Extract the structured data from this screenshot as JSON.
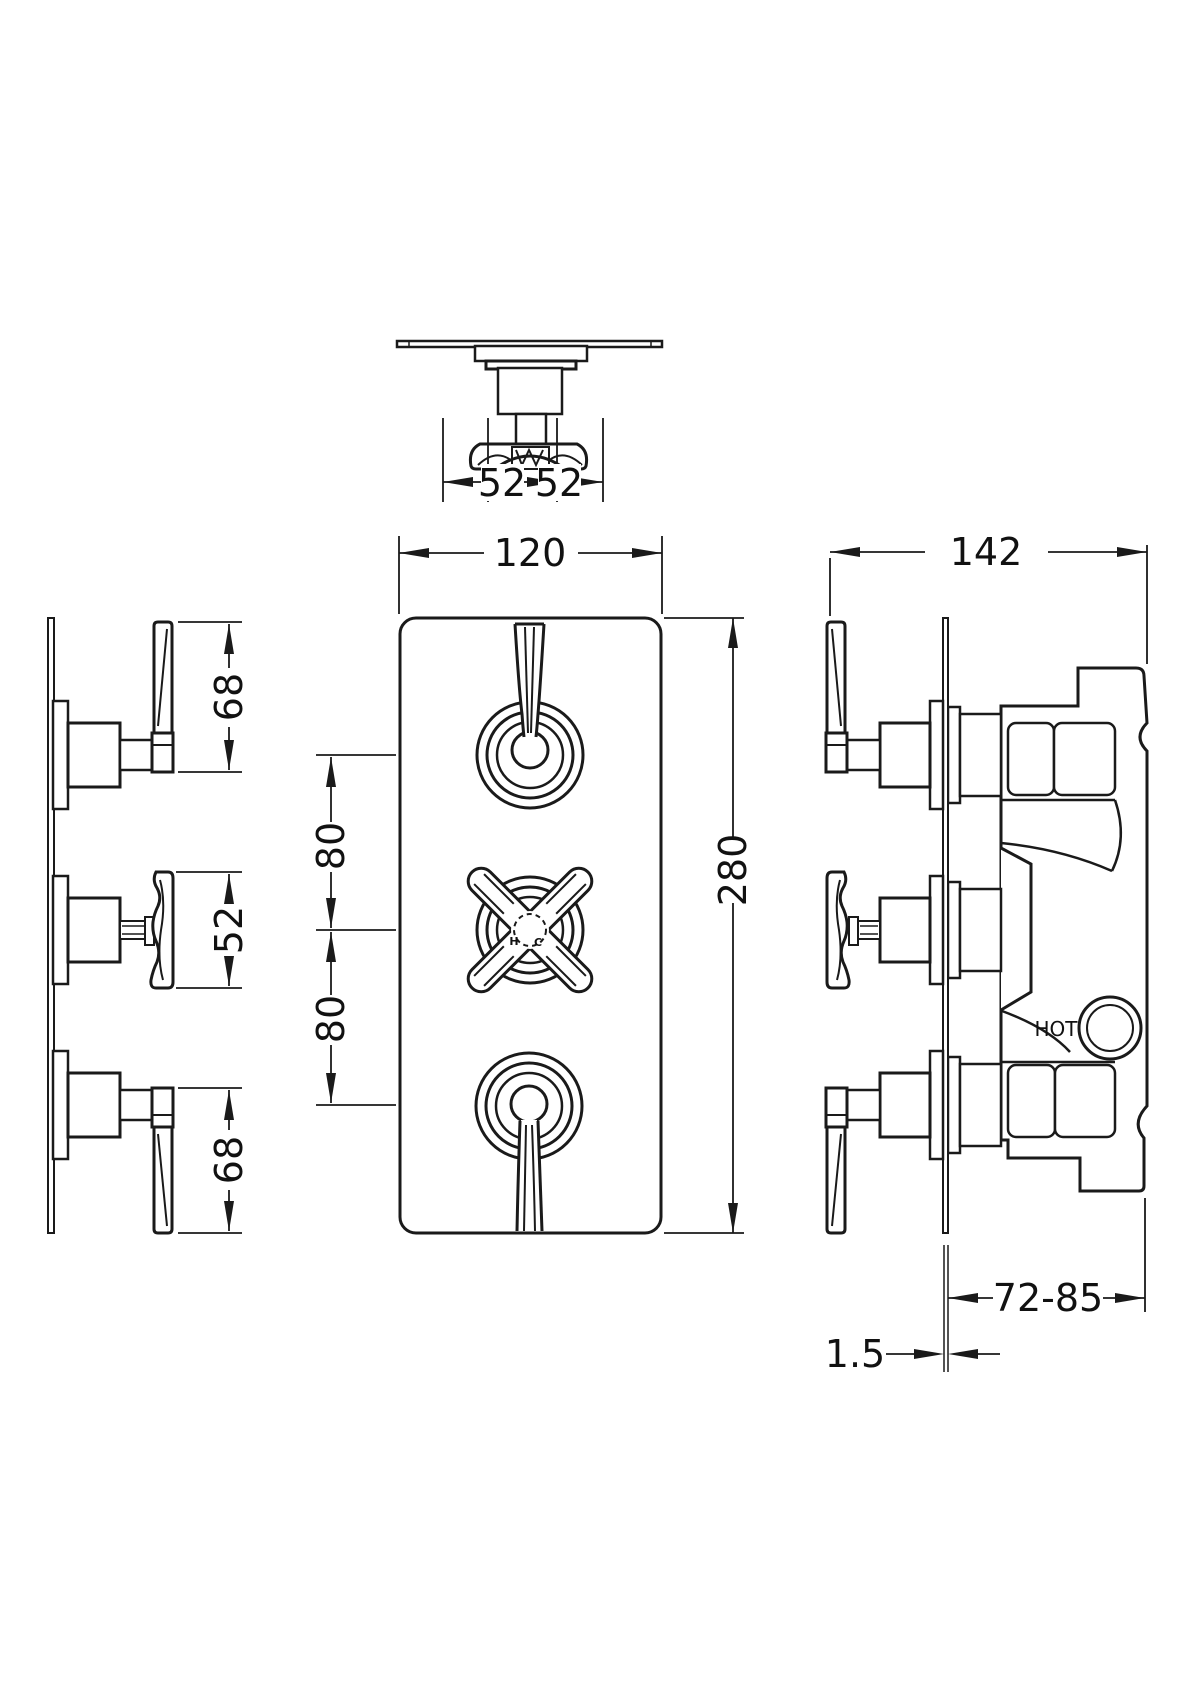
{
  "drawing": {
    "colors": {
      "line": "#1a1a1a",
      "background": "#ffffff"
    },
    "dimensions": {
      "top_view": {
        "left": "52",
        "right": "52"
      },
      "front_view": {
        "plate_width": "120",
        "plate_height": "280",
        "upper_spacing": "80",
        "lower_spacing": "80"
      },
      "left_view": {
        "top_lever": "68",
        "middle_handle": "52",
        "bottom_lever": "68"
      },
      "right_view": {
        "overall_depth": "142",
        "recess_depth": "72-85",
        "plate_thickness": "1.5"
      }
    },
    "labels": {
      "hot_port": "HOT",
      "hot_mark": "H",
      "cold_mark": "C"
    }
  }
}
